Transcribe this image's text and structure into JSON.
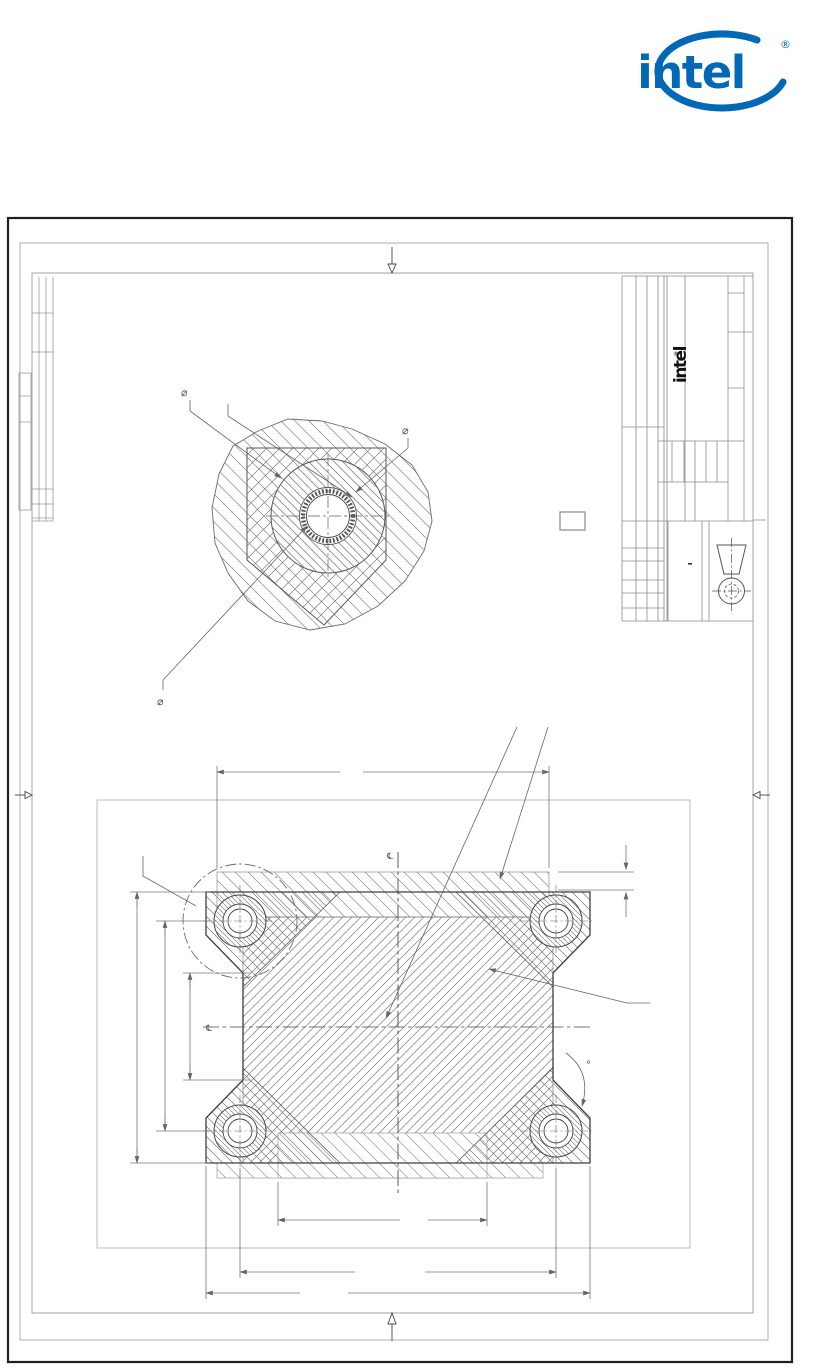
{
  "header": {
    "brand": "intel",
    "registered": "®",
    "brand_color": "#0068B5"
  },
  "title_block": {
    "brand": "intel",
    "registered": "®"
  },
  "labels": {
    "diameter": "⌀",
    "degree": "°",
    "centerline_mark": "℄"
  },
  "colors": {
    "page_border": "#1f1f1f",
    "sheet_frame": "#9a9a9a",
    "drawing_line": "#3d3d3d",
    "hatch_line": "#7a7a7a",
    "dimension_line": "#777777",
    "centerline": "#5f5f5f",
    "intel_blue": "#0068B5"
  },
  "views": {
    "detail_view": "corner-hole-detail",
    "section_view": "plate-section-with-four-holes"
  }
}
